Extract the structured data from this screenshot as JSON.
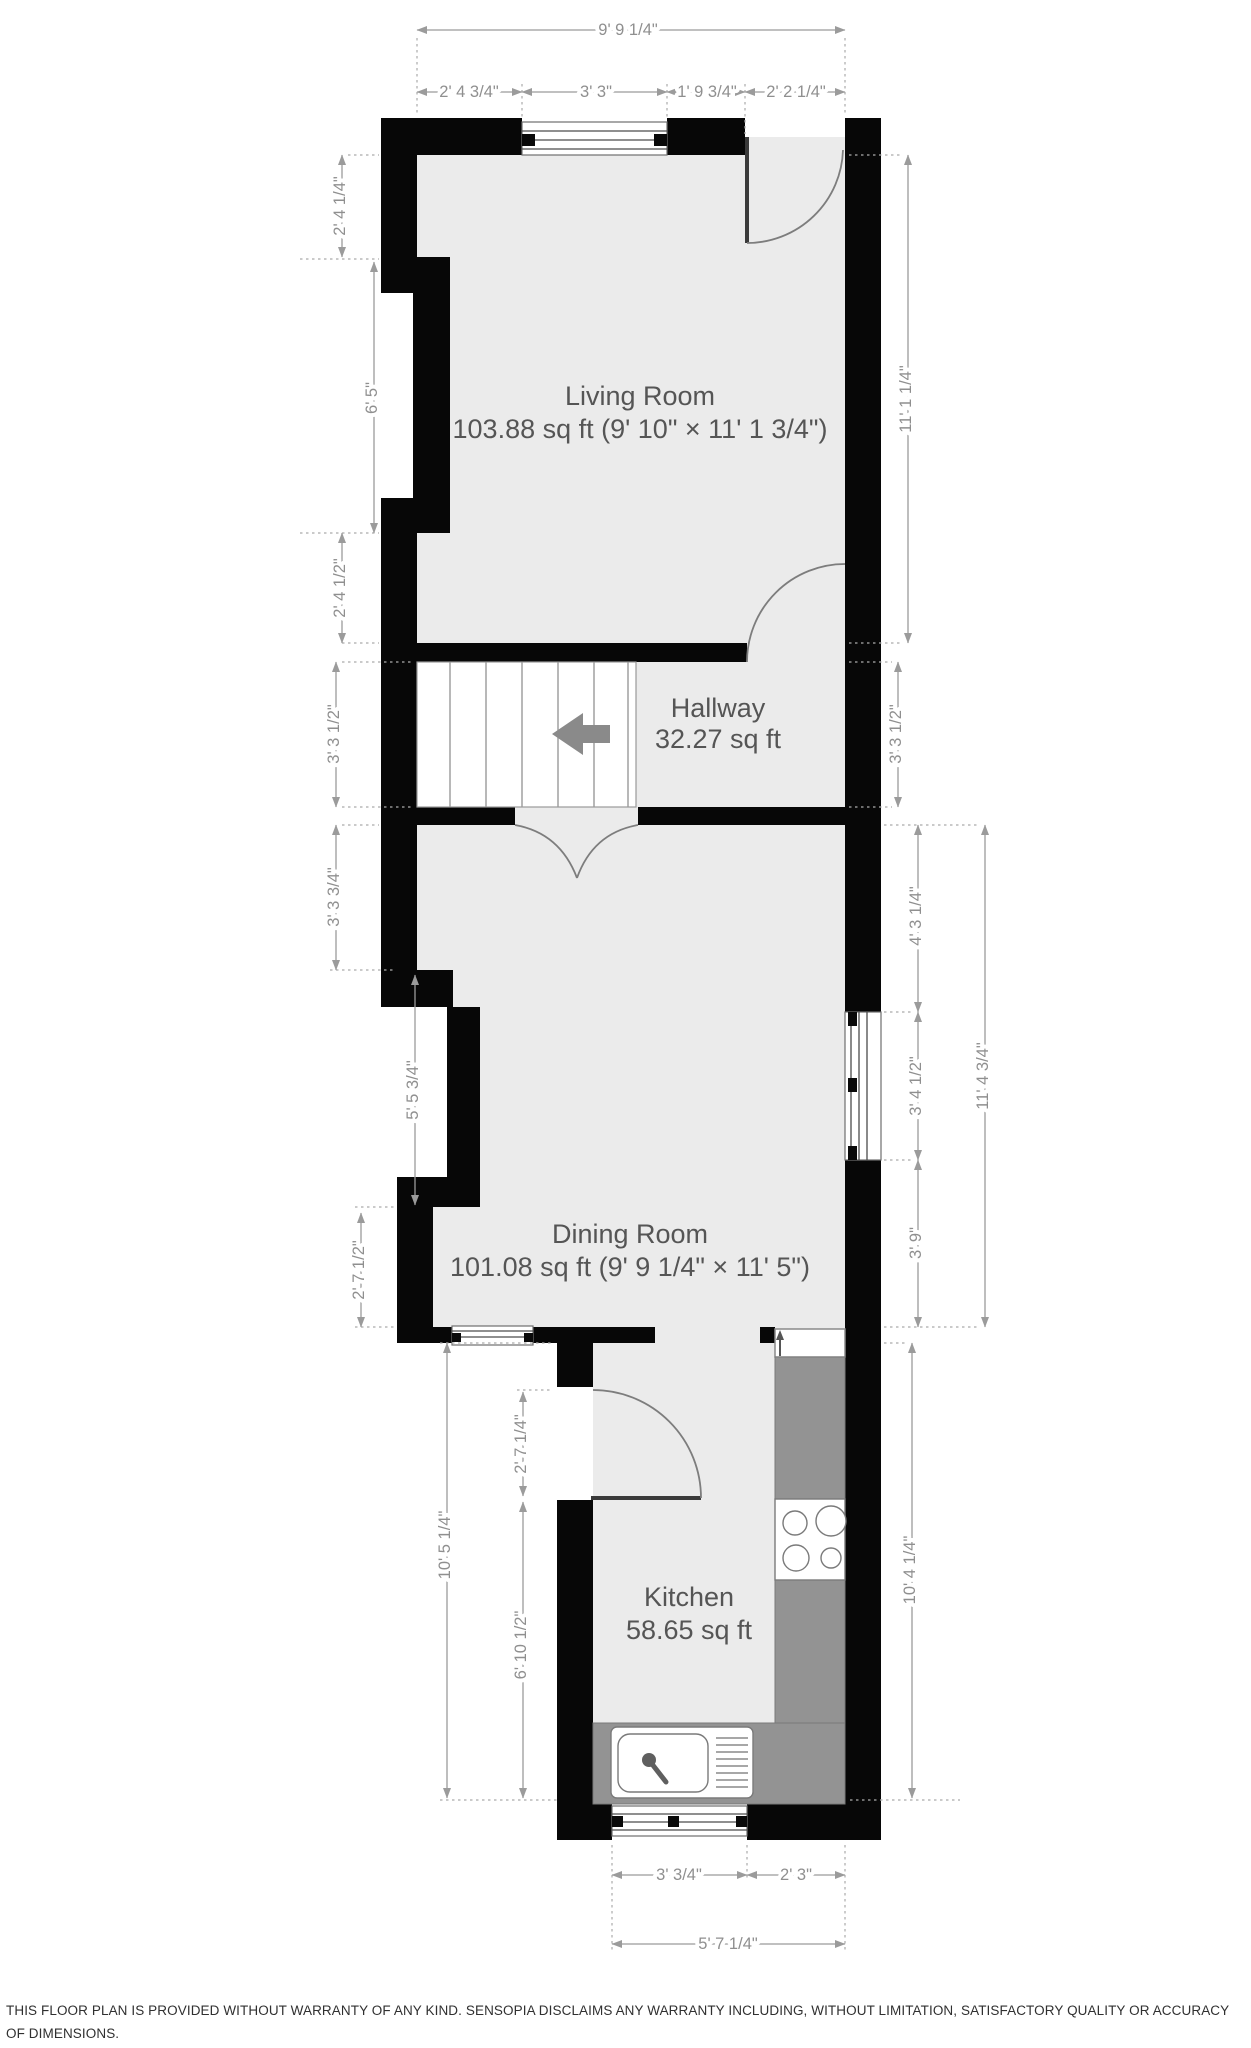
{
  "plan_title": "Ground floor plan",
  "rooms": {
    "living": {
      "name": "Living Room",
      "area": "103.88 sq ft (9' 10\" × 11' 1 3/4\")"
    },
    "hallway": {
      "name": "Hallway",
      "area": "32.27 sq ft"
    },
    "dining": {
      "name": "Dining Room",
      "area": "101.08 sq ft (9' 9 1/4\" × 11' 5\")"
    },
    "kitchen": {
      "name": "Kitchen",
      "area": "58.65 sq ft"
    }
  },
  "dims": {
    "top_total": "9' 9 1/4\"",
    "top_wall_left": "2' 4 3/4\"",
    "top_window": "3' 3\"",
    "top_wall_right": "1' 9 3/4\"",
    "top_door": "2' 2 1/4\"",
    "left_lr_upper": "2' 4 1/4\"",
    "left_lr_recess": "6' 5\"",
    "left_lr_lower": "2' 4 1/2\"",
    "left_hall": "3' 3 1/2\"",
    "left_dr_upper": "3' 3 3/4\"",
    "left_dr_recess": "5' 5 3/4\"",
    "left_dr_lower": "2' 7 1/2\"",
    "kitchen_door": "2' 7 1/4\"",
    "left_kitchen_total": "10' 5 1/4\"",
    "left_kitchen_lower": "6' 10 1/2\"",
    "right_lr": "11' 1 1/4\"",
    "right_hall": "3' 3 1/2\"",
    "right_dr_upper": "4' 3 1/4\"",
    "right_dr_window": "3' 4 1/2\"",
    "right_dr_lower": "3' 9\"",
    "right_dr_total": "11' 4 3/4\"",
    "right_kitchen": "10' 4 1/4\"",
    "bottom_window": "3' 3/4\"",
    "bottom_wall": "2' 3\"",
    "bottom_total": "5' 7 1/4\""
  },
  "colors": {
    "wall": "#070707",
    "floor": "#ebebeb",
    "counter": "#939393",
    "dimension": "#8f8f8f",
    "label": "#555555"
  },
  "disclaimer": "THIS FLOOR PLAN IS PROVIDED WITHOUT WARRANTY OF ANY KIND. SENSOPIA DISCLAIMS ANY WARRANTY INCLUDING, WITHOUT LIMITATION, SATISFACTORY QUALITY OR ACCURACY OF DIMENSIONS."
}
